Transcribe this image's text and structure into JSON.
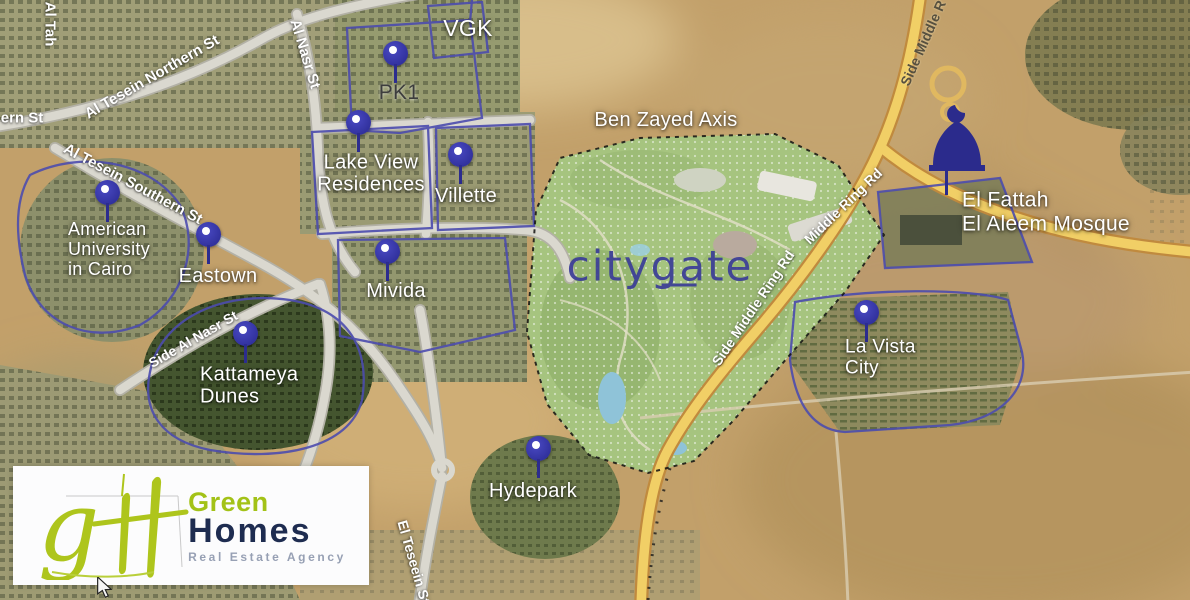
{
  "map": {
    "place_labels": [
      {
        "name": "vgk",
        "lines": [
          "VGK"
        ],
        "x": 468,
        "y": 29,
        "size": 23,
        "align": "center",
        "color": "#ffffff"
      },
      {
        "name": "pk1",
        "lines": [
          "PK1"
        ],
        "x": 399,
        "y": 93,
        "size": 21,
        "align": "center",
        "color": "#3d3d3d"
      },
      {
        "name": "lake-view-residences",
        "lines": [
          "Lake View",
          "Residences"
        ],
        "x": 371,
        "y": 174,
        "size": 20,
        "align": "center",
        "color": "#ffffff"
      },
      {
        "name": "villette",
        "lines": [
          "Villette"
        ],
        "x": 466,
        "y": 196,
        "size": 20,
        "align": "center",
        "color": "#ffffff"
      },
      {
        "name": "american-university-in-cairo",
        "lines": [
          "American",
          "University",
          "in Cairo"
        ],
        "x": 68,
        "y": 249,
        "size": 18,
        "align": "left",
        "color": "#ffffff"
      },
      {
        "name": "eastown",
        "lines": [
          "Eastown"
        ],
        "x": 218,
        "y": 276,
        "size": 20,
        "align": "center",
        "color": "#ffffff"
      },
      {
        "name": "mivida",
        "lines": [
          "Mivida"
        ],
        "x": 396,
        "y": 291,
        "size": 20,
        "align": "center",
        "color": "#ffffff"
      },
      {
        "name": "kattameya-dunes",
        "lines": [
          "Kattameya",
          "Dunes"
        ],
        "x": 200,
        "y": 386,
        "size": 20,
        "align": "left",
        "color": "#ffffff"
      },
      {
        "name": "la-vista-city",
        "lines": [
          "La Vista",
          "City"
        ],
        "x": 845,
        "y": 358,
        "size": 19,
        "align": "left",
        "color": "#ffffff"
      },
      {
        "name": "hydepark",
        "lines": [
          "Hydepark"
        ],
        "x": 533,
        "y": 491,
        "size": 20,
        "align": "center",
        "color": "#ffffff"
      },
      {
        "name": "el-fattah-el-aleem-mosque",
        "lines": [
          "El Fattah",
          "El Aleem Mosque"
        ],
        "x": 962,
        "y": 212,
        "size": 21,
        "align": "left",
        "color": "#ffffff"
      },
      {
        "name": "ben-zayed-axis",
        "lines": [
          "Ben Zayed Axis"
        ],
        "x": 666,
        "y": 120,
        "size": 20,
        "align": "center",
        "color": "#ffffff"
      }
    ],
    "road_labels": [
      {
        "name": "al-tah",
        "text": "Al Tah",
        "x": 50,
        "y": 24,
        "rotate": 90,
        "size": 15,
        "color": "#ffffff"
      },
      {
        "name": "ern-st",
        "text": "ern St",
        "x": 22,
        "y": 118,
        "rotate": 0,
        "size": 15,
        "color": "#ffffff"
      },
      {
        "name": "al-tesein-northern-st",
        "text": "Al Tesein Northern St",
        "x": 152,
        "y": 77,
        "rotate": -30,
        "size": 15,
        "color": "#ffffff"
      },
      {
        "name": "al-nasr-st",
        "text": "Al Nasr St",
        "x": 305,
        "y": 54,
        "rotate": 73,
        "size": 15,
        "color": "#ffffff"
      },
      {
        "name": "al-tesein-southern-st",
        "text": "Al Tesein Southern St",
        "x": 133,
        "y": 184,
        "rotate": 28,
        "size": 15,
        "color": "#ffffff"
      },
      {
        "name": "side-al-nasr-st",
        "text": "Side Al Nasr St",
        "x": 193,
        "y": 339,
        "rotate": -30,
        "size": 14,
        "color": "#ffffff"
      },
      {
        "name": "el-teseein-st",
        "text": "El Teseein St",
        "x": 414,
        "y": 562,
        "rotate": 74,
        "size": 14,
        "color": "#ffffff"
      },
      {
        "name": "side-middle-r",
        "text": "Side Middle R",
        "x": 923,
        "y": 43,
        "rotate": -66,
        "size": 14,
        "color": "#57503f"
      },
      {
        "name": "middle-ring-rd",
        "text": "Middle Ring Rd",
        "x": 843,
        "y": 206,
        "rotate": -44,
        "size": 14,
        "color": "#ffffff"
      },
      {
        "name": "side-middle-ring-rd",
        "text": "Side Middle Ring Rd",
        "x": 753,
        "y": 308,
        "rotate": -56,
        "size": 14,
        "color": "#ffffff"
      }
    ],
    "pins": [
      {
        "name": "pk1",
        "x": 395,
        "y": 53
      },
      {
        "name": "lake-view-residences",
        "x": 358,
        "y": 122
      },
      {
        "name": "villette",
        "x": 460,
        "y": 154
      },
      {
        "name": "american-university-in-cairo",
        "x": 107,
        "y": 192
      },
      {
        "name": "eastown",
        "x": 208,
        "y": 234
      },
      {
        "name": "mivida",
        "x": 387,
        "y": 251
      },
      {
        "name": "kattameya-dunes",
        "x": 245,
        "y": 333
      },
      {
        "name": "la-vista-city",
        "x": 866,
        "y": 312
      },
      {
        "name": "hydepark",
        "x": 538,
        "y": 448
      }
    ],
    "development_logo": {
      "text": "citygate",
      "x": 660,
      "y": 266,
      "color": "#3c3e97"
    },
    "mosque_icon": {
      "x": 957,
      "y": 163,
      "color": "#2b2b8c"
    },
    "pin_color": "#3737a8",
    "cursor": {
      "x": 96,
      "y": 577
    }
  },
  "watermark": {
    "monogram_g": "g",
    "monogram_h": "H",
    "brand_line1": "Green",
    "brand_line2": "Homes",
    "brand_line3": "Real Estate Agency",
    "accent_color": "#a3c217",
    "navy_color": "#1e2c50"
  }
}
